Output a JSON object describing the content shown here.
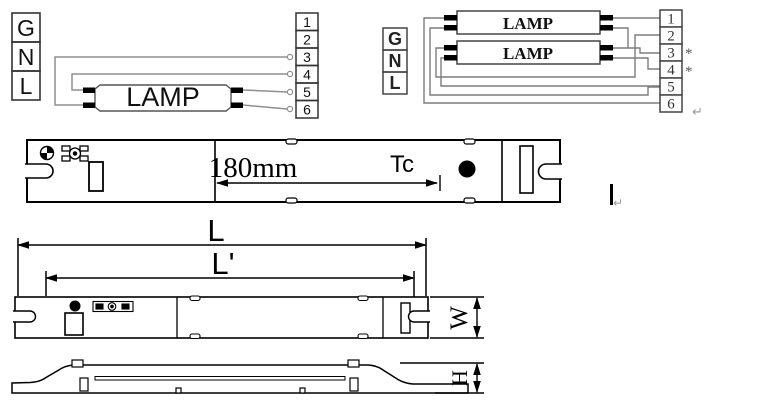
{
  "single_lamp_diagram": {
    "input_terminals": [
      "G",
      "N",
      "L"
    ],
    "lamp_label": "LAMP",
    "output_terminals": [
      "1",
      "2",
      "3",
      "4",
      "5",
      "6"
    ]
  },
  "dual_lamp_diagram": {
    "input_terminals": [
      "G",
      "N",
      "L"
    ],
    "lamp1_label": "LAMP",
    "lamp2_label": "LAMP",
    "output_terminals": [
      "1",
      "2",
      "3",
      "4",
      "5",
      "6"
    ],
    "asterisk_marked_terminals": [
      "3",
      "4"
    ],
    "asterisk_symbol": "*",
    "return_mark": "↵"
  },
  "top_view": {
    "tc_distance_label": "180mm",
    "tc_point_label": "Tc",
    "return_mark": "↵"
  },
  "dimension_views": {
    "overall_length_label": "L",
    "mounting_length_label": "L'",
    "width_label": "W",
    "height_label": "H"
  },
  "colors": {
    "ink": "#000000",
    "wire_gray": "#8f8f8f",
    "block_gray": "#4a4a4a",
    "cursor_gray": "#999999",
    "background": "#ffffff"
  }
}
